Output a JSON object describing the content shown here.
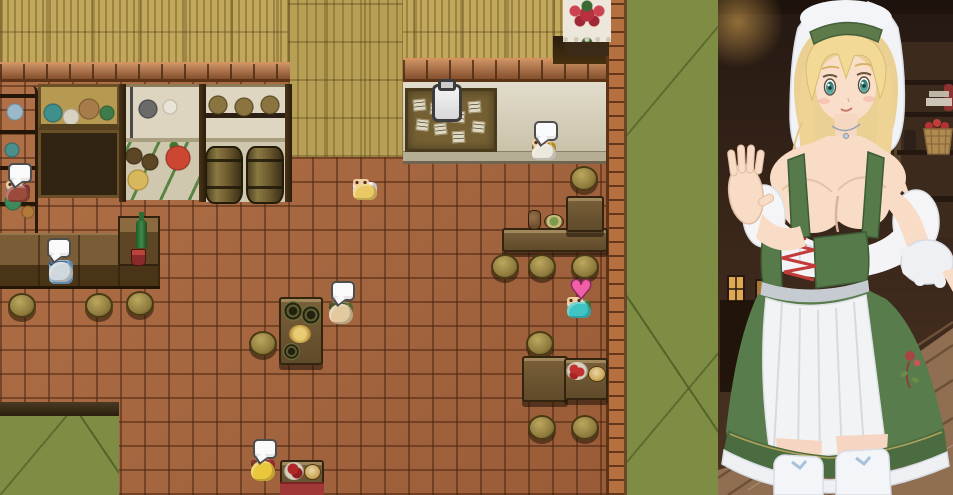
{
  "scene": {
    "name": "tavern-interior-map",
    "description": "top-down RPG tavern room with waitress portrait overlay"
  },
  "palette": {
    "floor_tile": "#a8663e",
    "floor_grout": "#7c4a2b",
    "straw_wall": "#c2a85c",
    "weave_wall": "#b7a055",
    "brick_cap": "#b06a3c",
    "brick_column": "#b4713f",
    "green_floor": "#7e8c44",
    "beige_counter": "#d8d1ba",
    "wood_dark": "#4a3418",
    "wood_mid": "#6b5434",
    "bubble_bg": "#fafafa",
    "bubble_border": "#4e4e4e",
    "heart_pink": "#f05fa8",
    "clipboard_grey": "#e8e8e8",
    "portrait_bg": "#39261a"
  },
  "indicators": {
    "heart_glyph": "♥",
    "speech_bubble_count": 5,
    "clipboard_line_count": 3
  },
  "labels": {
    "bulletin_board": "Bulletin board with pinned notices",
    "clipboard_icon": "Notice / quest board icon",
    "speech_bubble": "Speech bubble",
    "heart": "Affection heart indicator",
    "portrait": "Tavern waitress portrait",
    "roses": "Rose bouquet on lace cloth",
    "wine": "Wine bottle and cup on bar"
  },
  "characters": [
    {
      "id": "villager-red",
      "role": "villager by shelves",
      "hair": "#9c4a3c",
      "skin": "#f3cfa2",
      "outfit": "#933d3d",
      "pants": "#9a9a9a",
      "facing": "down",
      "has_bubble": true
    },
    {
      "id": "patron-blue",
      "role": "patron at bar",
      "hair": "#cfd8dd",
      "skin": "#f3cfa2",
      "outfit": "#7ba6ce",
      "pants": "#4a6e9c",
      "facing": "up",
      "has_bubble": true,
      "robe": true
    },
    {
      "id": "waitress-sprite",
      "role": "waitress walking",
      "hair": "#eac964",
      "skin": "#f3cfa2",
      "outfit": "#f2f2f2",
      "pants": "#ffffff",
      "facing": "down",
      "has_bubble": false
    },
    {
      "id": "elder-bald",
      "role": "old man by barrels",
      "hair": "#e2c9a0",
      "skin": "#e2c9a0",
      "outfit": "#6e7a3e",
      "pants": "#4c5526",
      "facing": "up",
      "has_bubble": true
    },
    {
      "id": "chef-turban",
      "role": "turbaned cook",
      "hair": "#ece8de",
      "skin": "#f3cfa2",
      "outfit": "#d9a92c",
      "pants": "#8a7848",
      "facing": "down",
      "has_bubble": true
    },
    {
      "id": "patron-teal",
      "role": "teal-haired patron",
      "hair": "#3fc4c4",
      "skin": "#f3cfa2",
      "outfit": "#4e8a4e",
      "pants": "#e8e8e8",
      "facing": "down",
      "has_bubble": false,
      "has_heart": true
    },
    {
      "id": "kid-blonde",
      "role": "child at low table",
      "hair": "#eac83e",
      "skin": "#f3cfa2",
      "outfit": "#b23434",
      "pants": "#7a3a2e",
      "facing": "up",
      "has_bubble": true
    }
  ],
  "portrait": {
    "subject": "blonde tavern waitress in green dirndl with white apron and veil",
    "hair_color": "#efd392",
    "eye_color": "#3f8f8c",
    "dress_color": "#587c4c",
    "apron_color": "#f2f3f5",
    "veil_color": "#f2f3f6",
    "lacing_color": "#c23a3a",
    "background_props": [
      "wooden shelf",
      "apple basket",
      "red bottle",
      "lit windows",
      "plank floor"
    ]
  }
}
